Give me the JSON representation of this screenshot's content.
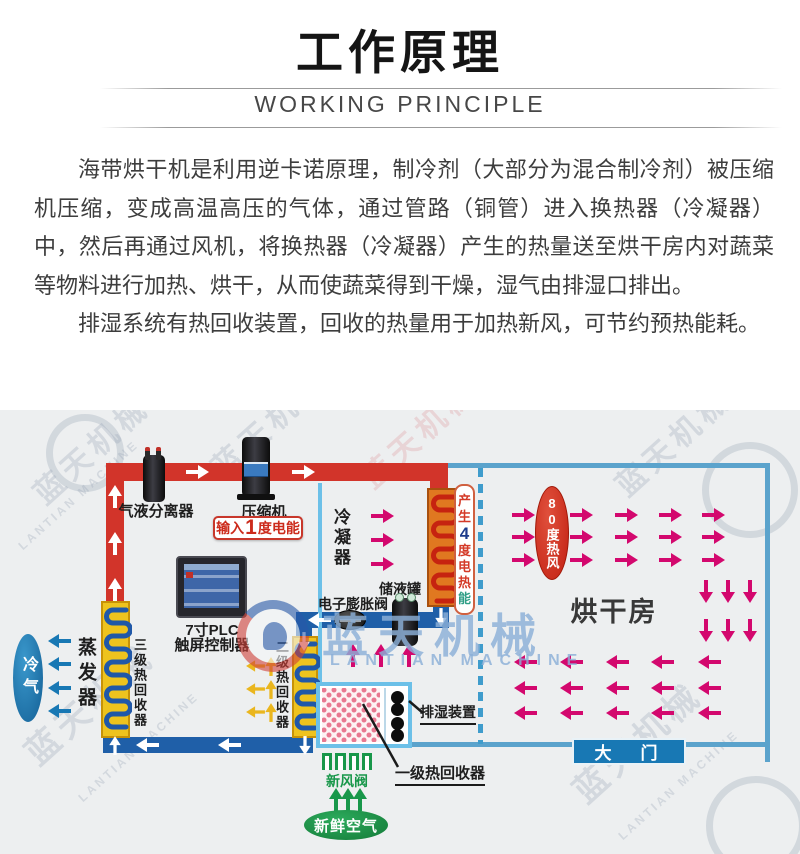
{
  "header": {
    "title": "工作原理",
    "subtitle": "WORKING PRINCIPLE"
  },
  "body": {
    "paragraphs": [
      "海带烘干机是利用逆卡诺原理，制冷剂（大部分为混合制冷剂）被压缩机压缩，变成高温高压的气体，通过管路（铜管）进入换热器（冷凝器）中，然后再通过风机，将换热器（冷凝器）产生的热量送至烘干房内对蔬菜等物料进行加热、烘干，从而使蔬菜得到干燥，湿气由排湿口排出。",
      "排湿系统有热回收装置，回收的热量用于加热新风，可节约预热能耗。"
    ]
  },
  "diagram": {
    "separator_label": "气液分离器",
    "compressor_label": "压缩机",
    "input_energy": {
      "prefix": "输入",
      "number": "1",
      "suffix": "度电能"
    },
    "condenser_label": "冷凝器",
    "produce_heat": {
      "chars": [
        {
          "ch": "产",
          "color": "#d43a28"
        },
        {
          "ch": "生",
          "color": "#d43a28"
        },
        {
          "ch": "4",
          "color": "#1e3c8c"
        },
        {
          "ch": "度",
          "color": "#d43a28"
        },
        {
          "ch": "电",
          "color": "#d43a28"
        },
        {
          "ch": "热",
          "color": "#d43a28"
        },
        {
          "ch": "能",
          "color": "#2f9e86"
        }
      ]
    },
    "hot_air_label": "80度热风",
    "drying_room_label": "烘干房",
    "door_label": "大　门",
    "plc_label_line1": "7寸PLC",
    "plc_label_line2": "触屏控制器",
    "tank_label": "储液罐",
    "valve_label": "电子膨胀阀",
    "recovery2_label": "二级热回收器",
    "recovery3_label": "三级热回收器",
    "evaporator_label": "蒸发器",
    "cold_air_label": "冷气",
    "dehumidifier_label": "排湿装置",
    "recovery1_label": "一级热回收器",
    "fresh_valve_label": "新风阀",
    "fresh_air_label": "新鲜空气",
    "watermark": {
      "cn": "蓝天机械",
      "en": "LANTIAN MACHINE"
    },
    "colors": {
      "hot_pipe": "#d2342a",
      "cold_pipe": "#1f5fa8",
      "condenser_case": "#e07820",
      "coil_case": "#eec31e",
      "magenta_arrow": "#d3086e",
      "blue_arrow": "#1878b4",
      "yellow_arrow": "#eab61e",
      "green": "#18974a",
      "room_border": "#5ba3cc",
      "door_bg": "#1878b4",
      "badge_red": "#cc2b1c"
    }
  }
}
